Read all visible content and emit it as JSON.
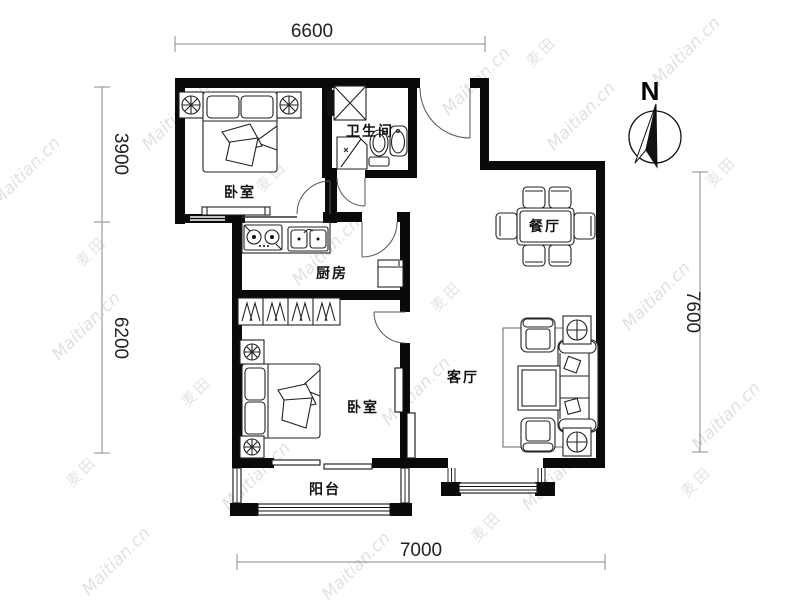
{
  "watermark": {
    "site": "Maitian.cn",
    "brand": "麦田"
  },
  "compass": {
    "north_label": "N"
  },
  "dimensions": {
    "top": "6600",
    "left_upper": "3900",
    "left_lower": "6200",
    "right": "7600",
    "bottom": "7000"
  },
  "rooms": {
    "bedroom_top": "卧室",
    "bathroom": "卫生间",
    "kitchen": "厨房",
    "dining": "餐厅",
    "living": "客厅",
    "bedroom_bottom": "卧室",
    "balcony": "阳台"
  },
  "colors": {
    "wall": "#0a0a0a",
    "furniture_line": "#222222",
    "dimension_line": "#888888",
    "watermark": "#c9c9c9",
    "background": "#ffffff"
  }
}
